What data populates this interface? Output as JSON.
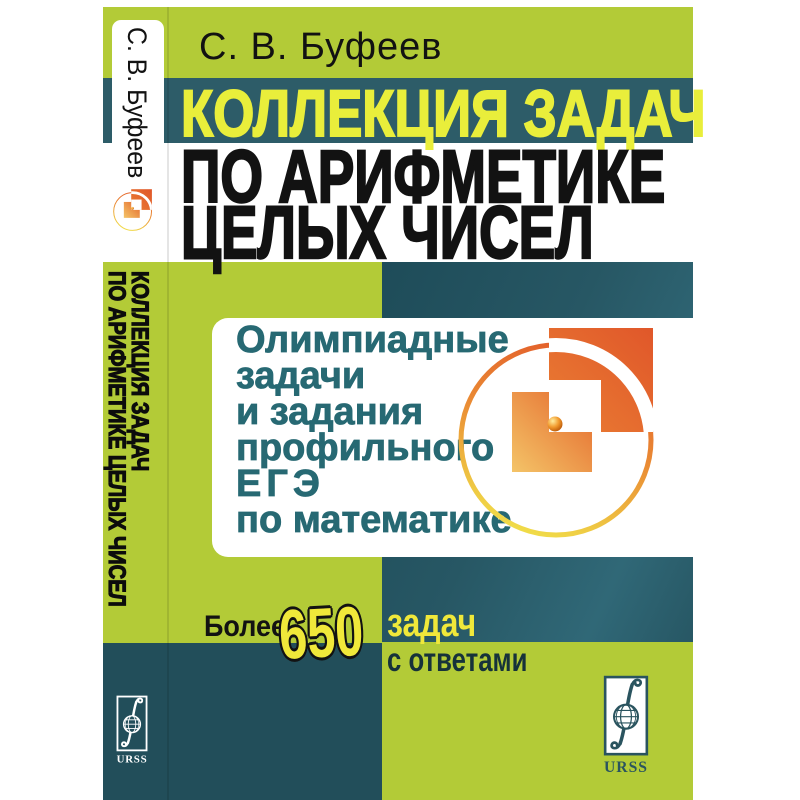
{
  "colors": {
    "green": "#b3cb37",
    "teal-band": "#2d5c68",
    "teal-panel": "#245663",
    "teal-bottom": "#224e5a",
    "yellow-title": "#e9ee3b",
    "yellow-badge": "#f0e83a",
    "box-teal": "#276973",
    "orange": "#e2602c"
  },
  "front": {
    "author": "С. В. Буфеев",
    "title": {
      "line1": "КОЛЛЕКЦИЯ ЗАДАЧ",
      "line2": "ПО АРИФМЕТИКЕ",
      "line3": "ЦЕЛЫХ ЧИСЕЛ"
    },
    "subtitle": {
      "lines": [
        "Олимпиадные",
        "задачи",
        "и задания",
        "профильного",
        "ЕГЭ",
        "по математике"
      ]
    },
    "badge": {
      "prefix": "Более",
      "count": "650",
      "word": "задач",
      "suffix": "с ответами"
    },
    "publisher": {
      "name": "URSS"
    }
  },
  "spine": {
    "author": "С. В. Буфеев",
    "title_line1": "КОЛЛЕКЦИЯ ЗАДАЧ",
    "title_line2": "ПО АРИФМЕТИКЕ ЦЕЛЫХ ЧИСЕЛ",
    "publisher": "URSS"
  }
}
